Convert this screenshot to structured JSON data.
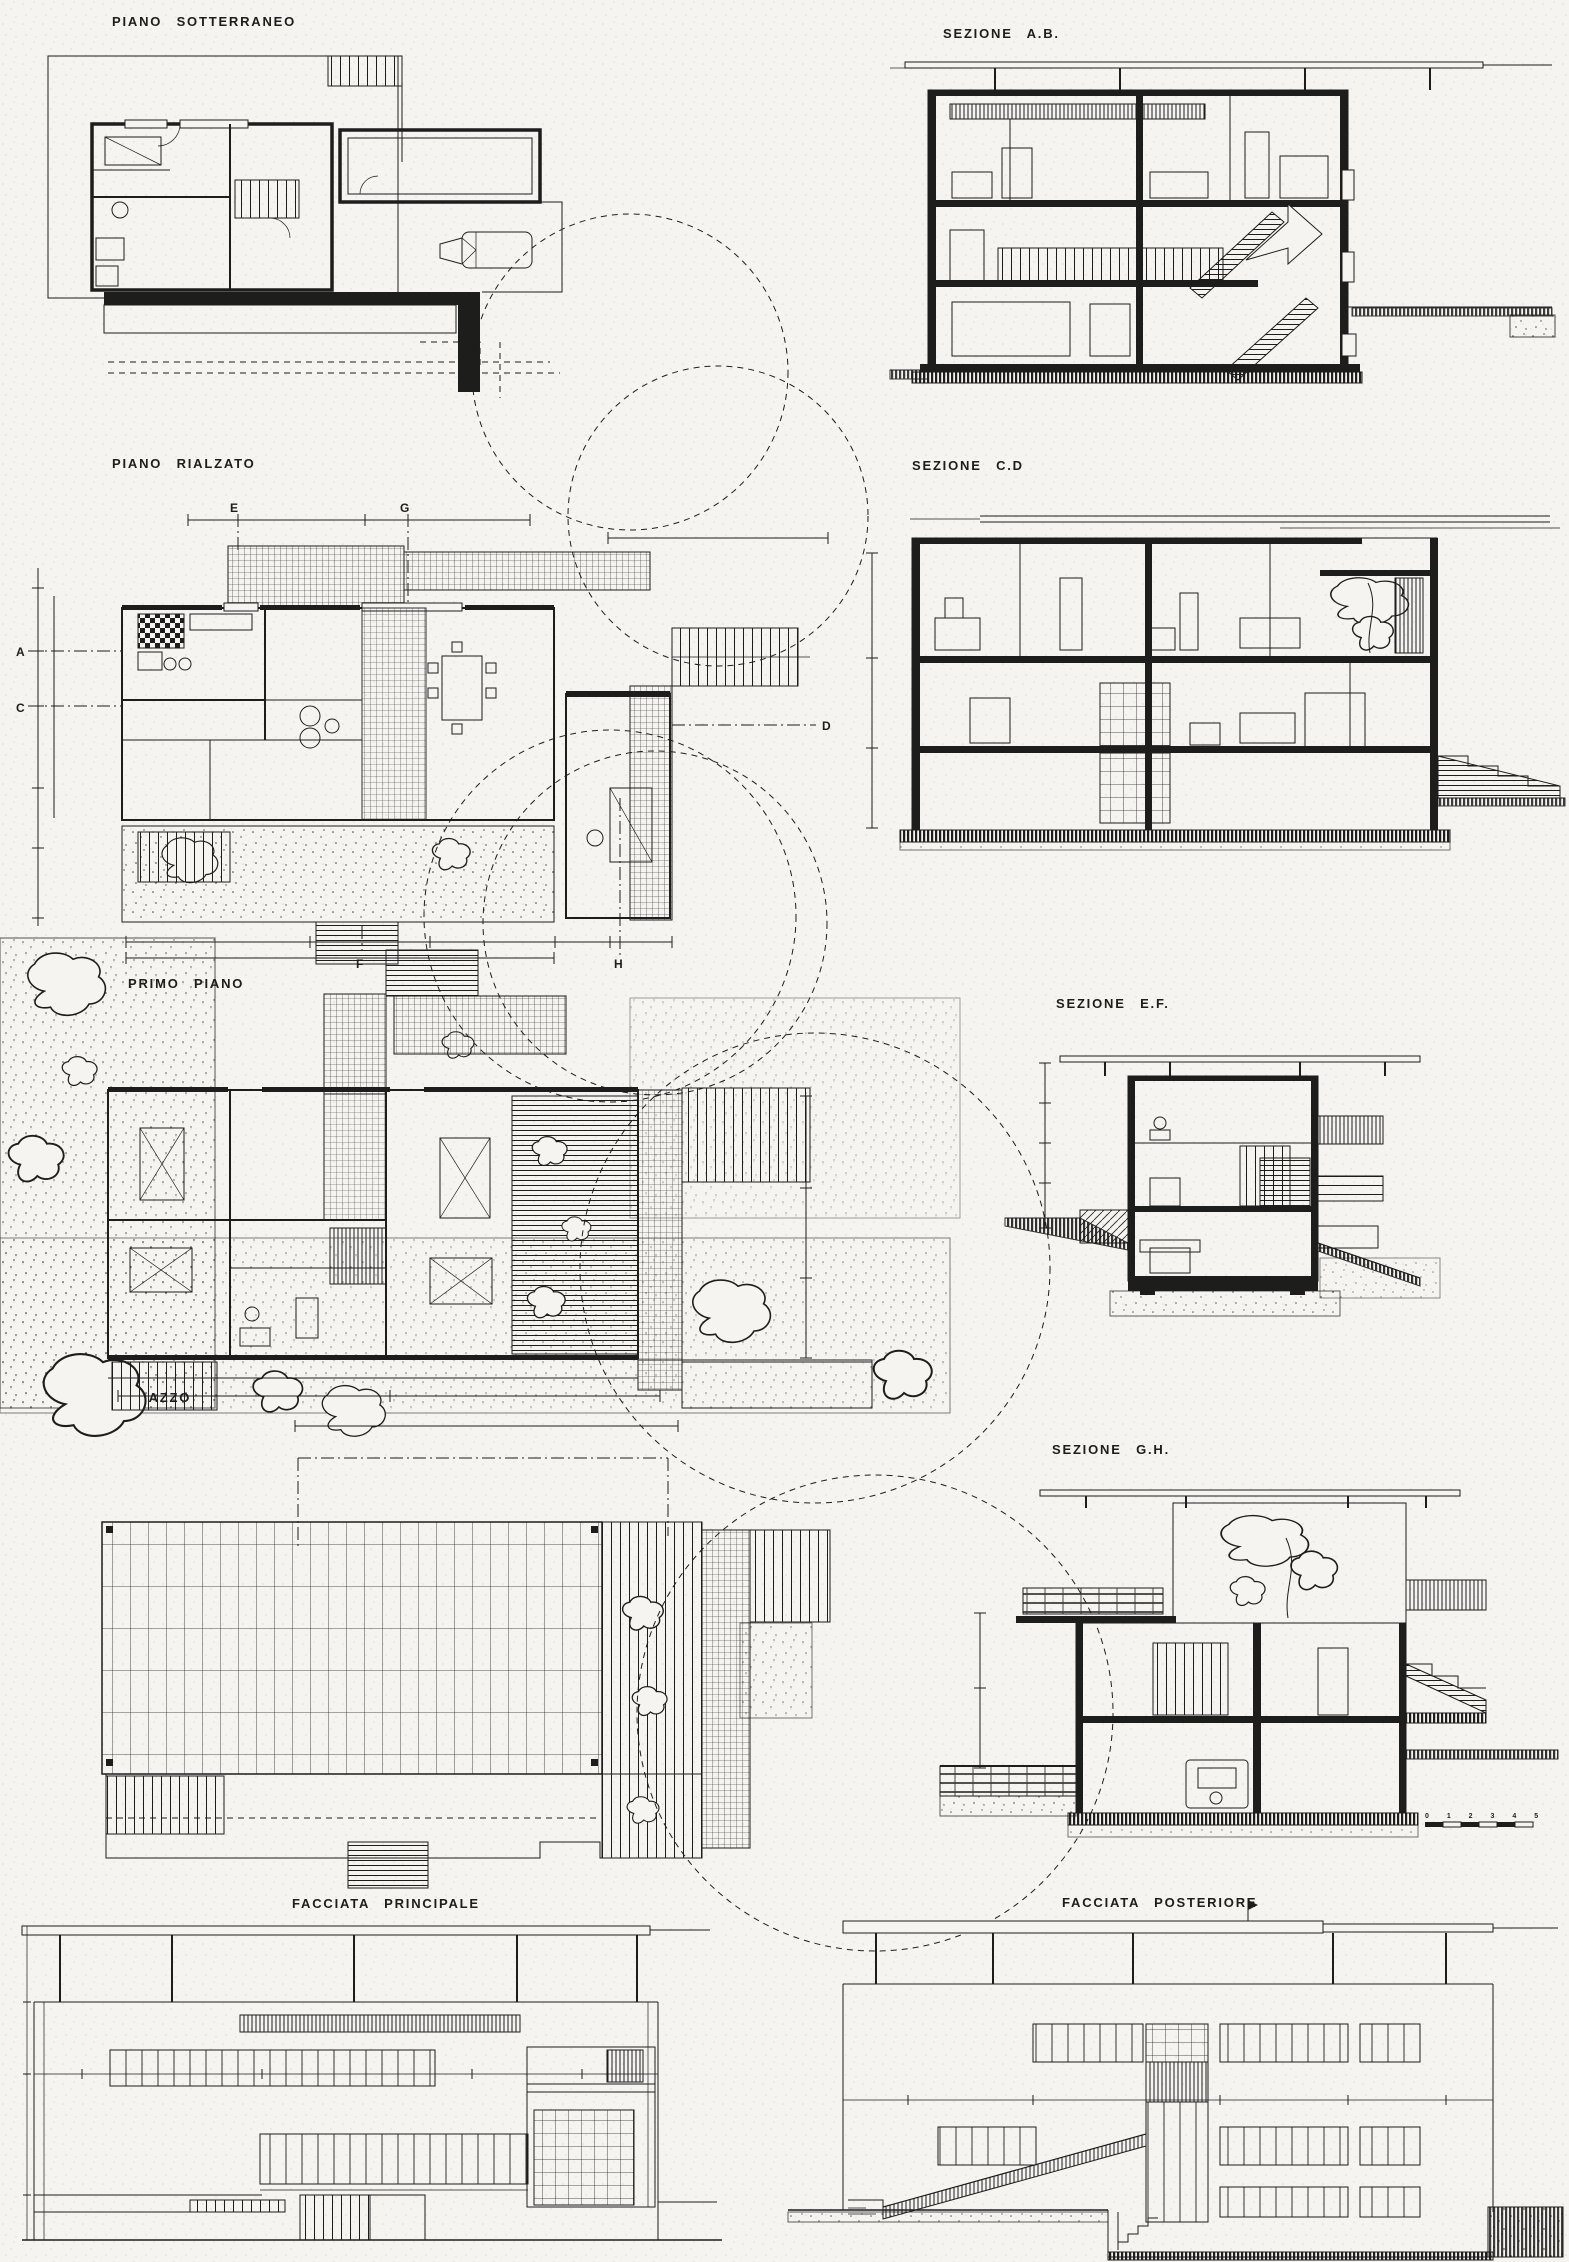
{
  "document": {
    "kind": "scanned architectural drawings sheet (plans, sections, elevations)",
    "language": "Italian",
    "paper_color": "#f5f4f1",
    "ink_color": "#1d1d1b"
  },
  "panels": [
    {
      "id": "piano-sotterraneo",
      "label": "PIANO SOTTERRANEO",
      "kind": "floor-plan"
    },
    {
      "id": "sezione-ab",
      "label": "SEZIONE A.B.",
      "kind": "section"
    },
    {
      "id": "piano-rialzato",
      "label": "PIANO RIALZATO",
      "kind": "floor-plan"
    },
    {
      "id": "sezione-cd",
      "label": "SEZIONE C.D",
      "kind": "section"
    },
    {
      "id": "primo-piano",
      "label": "PRIMO PIANO",
      "kind": "floor-plan"
    },
    {
      "id": "sezione-ef",
      "label": "SEZIONE E.F.",
      "kind": "section"
    },
    {
      "id": "terrazzo",
      "label": "TERRAZZO",
      "kind": "roof-plan"
    },
    {
      "id": "sezione-gh",
      "label": "SEZIONE G.H.",
      "kind": "section"
    },
    {
      "id": "facciata-principale",
      "label": "FACCIATA PRINCIPALE",
      "kind": "elevation"
    },
    {
      "id": "facciata-posteriore",
      "label": "FACCIATA POSTERIORE",
      "kind": "elevation"
    }
  ],
  "markers": [
    "E",
    "G",
    "A",
    "C",
    "D",
    "F",
    "H"
  ],
  "scale_bar": {
    "values": "0 1 2 3 4 5"
  }
}
